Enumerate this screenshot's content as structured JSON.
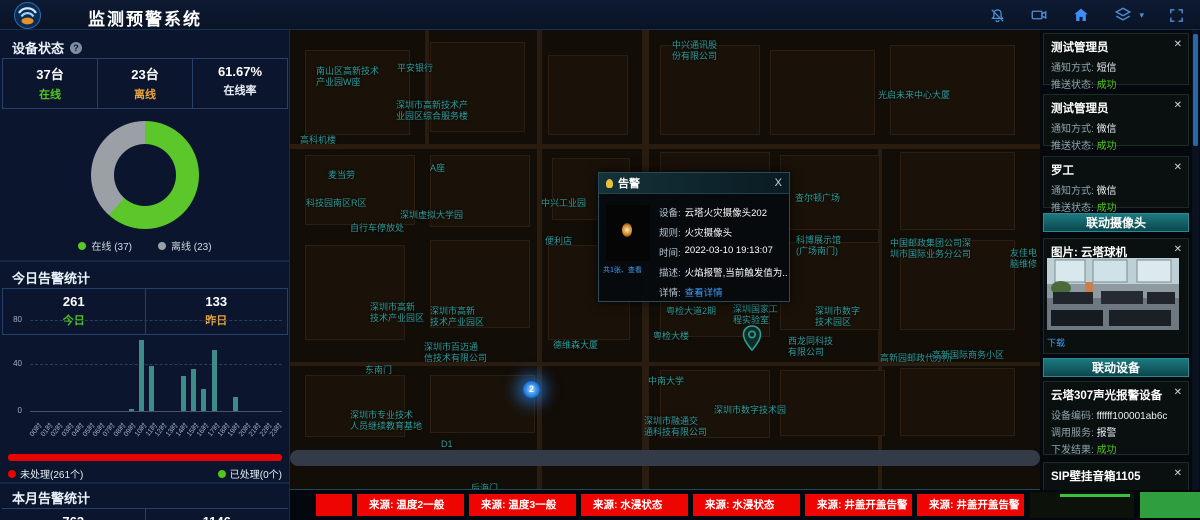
{
  "header": {
    "title": "监测预警系统",
    "icons": [
      "bell-off-icon",
      "video-camera-icon",
      "home-icon",
      "layers-icon",
      "fullscreen-icon"
    ]
  },
  "device_status": {
    "title": "设备状态",
    "stats": [
      {
        "value": "37台",
        "label": "在线"
      },
      {
        "value": "23台",
        "label": "离线"
      },
      {
        "value": "61.67%",
        "label": "在线率"
      }
    ],
    "legend": [
      "在线 (37)",
      "离线 (23)"
    ]
  },
  "today_alerts": {
    "title": "今日告警统计",
    "stats": [
      {
        "value": "261",
        "label": "今日"
      },
      {
        "value": "133",
        "label": "昨日"
      }
    ],
    "unhandled": "未处理(261个)",
    "handled": "已处理(0个)"
  },
  "month_alerts": {
    "title": "本月告警统计",
    "values": [
      "763",
      "1146"
    ]
  },
  "chart_data": [
    {
      "type": "pie",
      "title": "设备状态",
      "labels": [
        "在线",
        "离线"
      ],
      "values": [
        37,
        23
      ],
      "colors": [
        "#5bc72b",
        "#9aa0a6"
      ],
      "legend_position": "bottom",
      "donut": true
    },
    {
      "type": "bar",
      "title": "今日告警统计(按小时)",
      "categories": [
        "00时",
        "01时",
        "02时",
        "03时",
        "04时",
        "05时",
        "06时",
        "07时",
        "08时",
        "09时",
        "10时",
        "11时",
        "12时",
        "13时",
        "14时",
        "15时",
        "16时",
        "17时",
        "18时",
        "19时",
        "20时",
        "21时",
        "22时",
        "23时"
      ],
      "values": [
        0,
        0,
        0,
        0,
        0,
        0,
        0,
        0,
        0,
        2,
        62,
        40,
        0,
        0,
        31,
        37,
        19,
        54,
        0,
        12,
        0,
        0,
        0,
        0
      ],
      "xlabel": "",
      "ylabel": "",
      "ylim": [
        0,
        80
      ],
      "yticks": [
        "80",
        "40",
        "0"
      ],
      "bar_color": "#3c8d8a",
      "grid": "dashed"
    },
    {
      "type": "bar",
      "title": "告警处理进度",
      "categories": [
        "未处理",
        "已处理"
      ],
      "values": [
        261,
        0
      ],
      "colors": [
        "#e60500",
        "#52c41a"
      ]
    }
  ],
  "popup": {
    "title": "告警",
    "close": "X",
    "thumb_caption": "共1张、查看",
    "fields": [
      {
        "label": "设备:",
        "value": "云塔火灾摄像头202"
      },
      {
        "label": "规则:",
        "value": "火灾摄像头"
      },
      {
        "label": "时间:",
        "value": "2022-03-10 19:13:07"
      },
      {
        "label": "描述:",
        "value": "火焰报警,当前触发值为..."
      },
      {
        "label": "详情:",
        "value": "查看详情"
      }
    ]
  },
  "map": {
    "marker_label": "2",
    "labels": [
      {
        "t": "中兴通讯股\n份有限公司",
        "x": 382,
        "y": 10
      },
      {
        "t": "平安银行",
        "x": 107,
        "y": 33
      },
      {
        "t": "南山区高新技术\n产业园W座",
        "x": 26,
        "y": 36
      },
      {
        "t": "深圳市高新技术产\n业园区综合服务楼",
        "x": 106,
        "y": 70
      },
      {
        "t": "光启未来中心大厦",
        "x": 588,
        "y": 60
      },
      {
        "t": "高科机楼",
        "x": 10,
        "y": 105
      },
      {
        "t": "麦当劳",
        "x": 38,
        "y": 140
      },
      {
        "t": "A座",
        "x": 140,
        "y": 133
      },
      {
        "t": "科技园南区R区",
        "x": 16,
        "y": 168
      },
      {
        "t": "深圳虚拟大学园",
        "x": 110,
        "y": 180
      },
      {
        "t": "自行车停放处",
        "x": 60,
        "y": 193
      },
      {
        "t": "中兴工业园",
        "x": 251,
        "y": 168
      },
      {
        "t": "便利店",
        "x": 255,
        "y": 206
      },
      {
        "t": "查尔顿广场",
        "x": 505,
        "y": 163
      },
      {
        "t": "科博展示馆\n(广场南门)",
        "x": 506,
        "y": 205
      },
      {
        "t": "中国邮政集团公司深\n圳市国际业务分公司",
        "x": 600,
        "y": 208
      },
      {
        "t": "友佳电脑维修",
        "x": 720,
        "y": 218
      },
      {
        "t": "深圳市高新\n技术产业园区",
        "x": 80,
        "y": 272
      },
      {
        "t": "深圳市高新\n技术产业园区",
        "x": 140,
        "y": 276
      },
      {
        "t": "深圳市百迈通\n信技术有限公司",
        "x": 134,
        "y": 312
      },
      {
        "t": "东南门",
        "x": 75,
        "y": 335
      },
      {
        "t": "德维森大厦",
        "x": 263,
        "y": 310
      },
      {
        "t": "粤检大楼",
        "x": 363,
        "y": 301
      },
      {
        "t": "粤检大道2期",
        "x": 376,
        "y": 276
      },
      {
        "t": "深圳国家工\n程实验室",
        "x": 443,
        "y": 274
      },
      {
        "t": "中南大学",
        "x": 358,
        "y": 346
      },
      {
        "t": "深圳市专业技术\n人员继续教育基地",
        "x": 60,
        "y": 380
      },
      {
        "t": "深圳市融通交\n通科技有限公司",
        "x": 354,
        "y": 386
      },
      {
        "t": "深圳市数字技术园",
        "x": 424,
        "y": 375
      },
      {
        "t": "深圳市数字\n技术园区",
        "x": 525,
        "y": 276
      },
      {
        "t": "西龙同科技\n有限公司",
        "x": 498,
        "y": 306
      },
      {
        "t": "高新园邮政代办所",
        "x": 590,
        "y": 323
      },
      {
        "t": "高新国际商务小区",
        "x": 642,
        "y": 320
      },
      {
        "t": "D1",
        "x": 151,
        "y": 409
      },
      {
        "t": "后海门",
        "x": 181,
        "y": 453
      }
    ],
    "blocks": [
      [
        15,
        20,
        105,
        85
      ],
      [
        140,
        12,
        95,
        90
      ],
      [
        258,
        25,
        80,
        80
      ],
      [
        370,
        15,
        100,
        90
      ],
      [
        480,
        20,
        105,
        85
      ],
      [
        600,
        15,
        125,
        90
      ],
      [
        15,
        125,
        110,
        70
      ],
      [
        140,
        125,
        100,
        72
      ],
      [
        262,
        128,
        78,
        62
      ],
      [
        370,
        122,
        110,
        80
      ],
      [
        490,
        125,
        100,
        75
      ],
      [
        610,
        122,
        115,
        78
      ],
      [
        15,
        215,
        100,
        95
      ],
      [
        140,
        210,
        100,
        88
      ],
      [
        258,
        215,
        82,
        95
      ],
      [
        370,
        215,
        110,
        92
      ],
      [
        490,
        212,
        100,
        88
      ],
      [
        610,
        210,
        115,
        90
      ],
      [
        15,
        345,
        100,
        62
      ],
      [
        140,
        345,
        105,
        58
      ],
      [
        370,
        340,
        110,
        68
      ],
      [
        490,
        340,
        105,
        66
      ],
      [
        610,
        338,
        115,
        68
      ]
    ]
  },
  "right_panel": {
    "row_labels": {
      "method": "通知方式:",
      "status": "推送状态:"
    },
    "notify_cards": [
      {
        "name": "测试管理员",
        "method": "短信",
        "status": "成功"
      },
      {
        "name": "测试管理员",
        "method": "微信",
        "status": "成功"
      },
      {
        "name": "罗工",
        "method": "微信",
        "status": "成功"
      }
    ],
    "camera_section": {
      "header": "联动摄像头",
      "image_title": "图片: 云塔球机",
      "download": "下载"
    },
    "device_section": {
      "header": "联动设备",
      "device1": {
        "name": "云塔307声光报警设备",
        "rows": [
          {
            "label": "设备编码:",
            "value": "ffffff100001ab6c",
            "ok": false
          },
          {
            "label": "调用服务:",
            "value": "报警",
            "ok": false
          },
          {
            "label": "下发结果:",
            "value": "成功",
            "ok": true
          }
        ]
      },
      "device2": {
        "name": "SIP壁挂音箱1105",
        "rows": [
          {
            "label": "设备编码:",
            "value": "1106",
            "ok": false
          }
        ]
      }
    }
  },
  "bottom_bar": {
    "alerts": [
      "来源: 温度2一般",
      "来源: 温度3一般",
      "来源: 水浸状态",
      "来源: 水浸状态",
      "来源: 井盖开盖告警",
      "来源: 井盖开盖告警"
    ]
  }
}
